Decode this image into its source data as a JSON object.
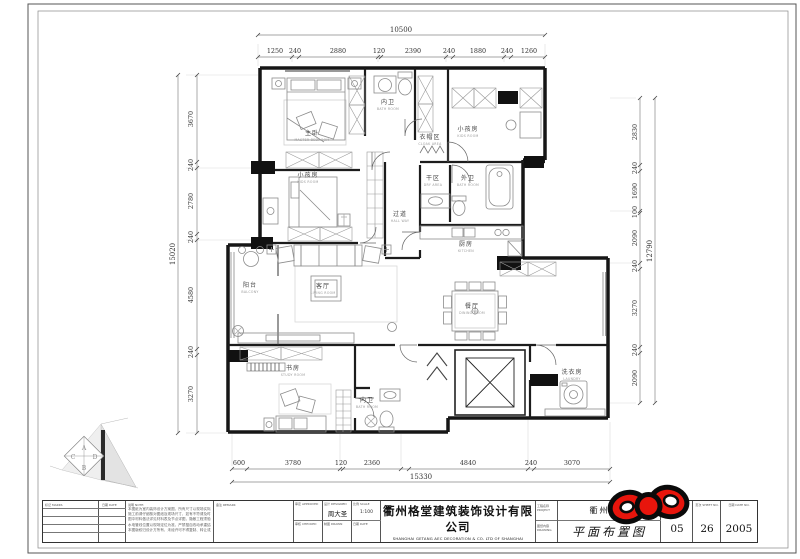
{
  "dimensions": {
    "top": {
      "overall": "10500",
      "segments": [
        "1250",
        "240",
        "2880",
        "120",
        "2390",
        "240",
        "1880",
        "240",
        "1260"
      ]
    },
    "left": {
      "overall": "15020",
      "segments": [
        "3670",
        "240",
        "2780",
        "240",
        "4580",
        "240",
        "3270"
      ]
    },
    "right": {
      "overall": "12790",
      "segments": [
        "2830",
        "240",
        "1690",
        "100",
        "2090",
        "240",
        "3270",
        "240",
        "2090"
      ]
    },
    "bottom": {
      "overall": "15330",
      "segments": [
        "600",
        "3780",
        "120",
        "2360",
        "4840",
        "240",
        "3070"
      ]
    }
  },
  "rooms": [
    {
      "name": "主卧",
      "sub": "MASTER BEDROOM"
    },
    {
      "name": "内卫",
      "sub": "BATH ROOM"
    },
    {
      "name": "衣帽区",
      "sub": "CLOAK AREA"
    },
    {
      "name": "小孩房",
      "sub": "KIDS ROOM"
    },
    {
      "name": "小孩房",
      "sub": "KIDS ROOM"
    },
    {
      "name": "干区",
      "sub": "DRY AREA"
    },
    {
      "name": "外卫",
      "sub": "BATH ROOM"
    },
    {
      "name": "过道",
      "sub": "HALL WAY"
    },
    {
      "name": "厨房",
      "sub": "KITCHEN"
    },
    {
      "name": "阳台",
      "sub": "BALCONY"
    },
    {
      "name": "客厅",
      "sub": "LIVING ROOM"
    },
    {
      "name": "餐厅",
      "sub": "DINING ROOM"
    },
    {
      "name": "书房",
      "sub": "STUDY ROOM"
    },
    {
      "name": "内卫",
      "sub": "BATH ROOM"
    },
    {
      "name": "洗衣房",
      "sub": "LAUNDRY"
    }
  ],
  "keyplan": {
    "a": "A",
    "b": "B",
    "c": "C",
    "d": "D"
  },
  "titleblock": {
    "rev_col1": "标记",
    "rev_col1_en": "MARKS",
    "rev_col2": "日期",
    "rev_col2_en": "DATE",
    "notes_label": "说明  NOTE:",
    "notes": [
      "本图纸为室内装饰设计方案图，所有尺寸以现场实际放样为准。",
      "施工前请仔细核对图纸及现场尺寸，如有不符请及时与设计师联系。",
      "图中材料做法详见材料表及节点详图，隐蔽工程须验收合格后方可封闭。",
      "水电管线位置以现场定位为准，严禁擅自改动承重结构。",
      "本图版权归设计方所有，未经许可不得复制、转让或用于其他工程。"
    ],
    "mid_label": "备注  REMARK",
    "sign": {
      "c1": "审定 APPROVED",
      "c2": "设计 DESIGNED",
      "c3": "比例 SCALE",
      "c4": "审核 CHECKED",
      "c5": "制图 DRAWN",
      "c6": "日期 DATE",
      "designer": "周大圣",
      "scale": "1:100"
    },
    "company_cn": "衢州格堂建筑装饰设计有限公司",
    "company_en": "SHANGHAI GETANG AEC DECORATION  &  CO. LTD OF SHANGHAI",
    "project_label": "工程名称",
    "project_label_en": "PROJECT",
    "project_name": "衢州公馆",
    "drawing_label": "图纸内容",
    "drawing_label_en": "DRAWING",
    "drawing_name": "平面布置图",
    "num": {
      "h1": "图号",
      "h1_en": "DWG NO.",
      "v1": "05",
      "h2": "页次",
      "h2_en": "SHEET NO.",
      "v2": "26",
      "h3": "日期",
      "h3_en": "DATE NO.",
      "v3": "2005"
    }
  }
}
